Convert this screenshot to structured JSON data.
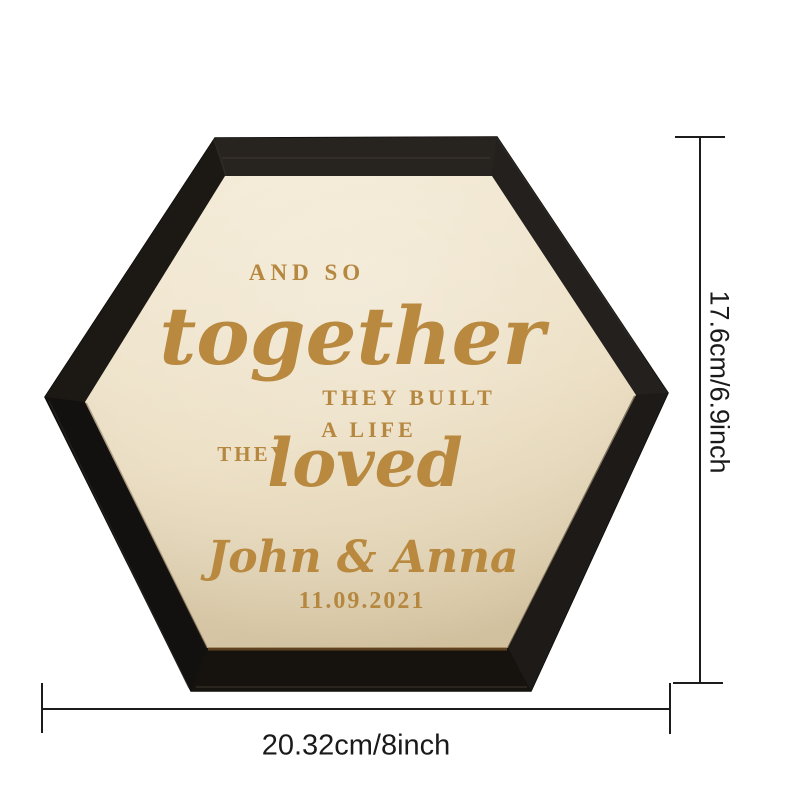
{
  "sign": {
    "quote": {
      "line1": "AND SO",
      "line2": "together",
      "line3": "THEY BUILT",
      "line4": "A LIFE",
      "line5_small": "THEY",
      "line5_script": "loved"
    },
    "names": "John & Anna",
    "date": "11.09.2021"
  },
  "dimensions": {
    "height_label": "17.6cm/6.9inch",
    "width_label": "20.32cm/8inch"
  },
  "colors": {
    "engraving": "#b5873f",
    "wood_light": "#f1e7d0",
    "wood_dark": "#ddcdab",
    "frame_black": "#1a1713",
    "dimension_line": "#1c1c1c",
    "background": "#ffffff"
  }
}
